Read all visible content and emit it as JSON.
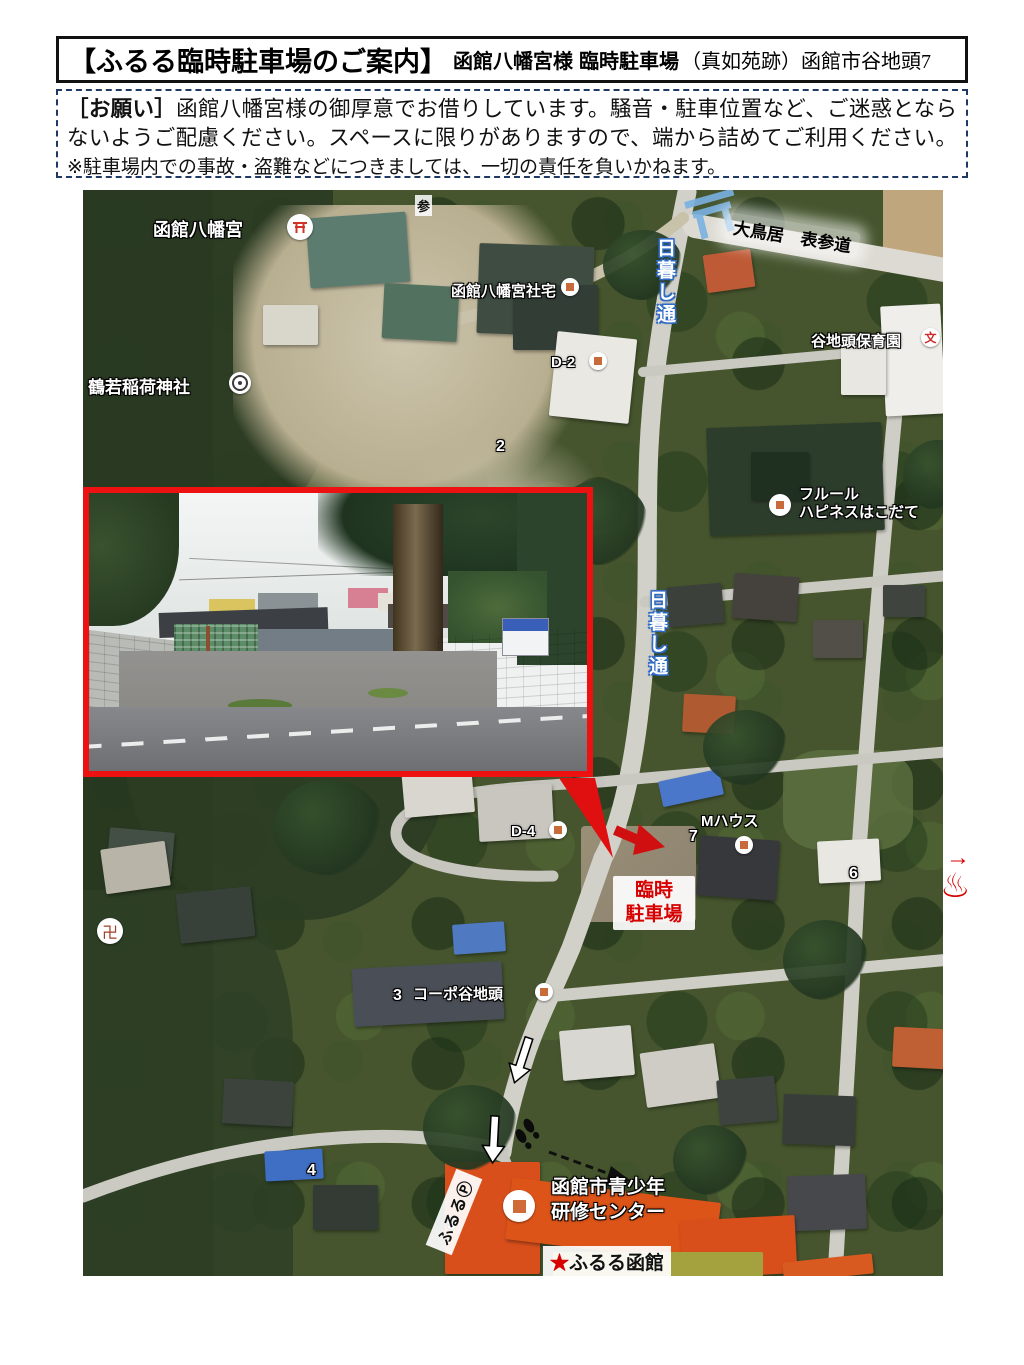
{
  "header": {
    "title_bracket": "【ふるる臨時駐車場のご案内】",
    "shrine_bold": "函館八幡宮様",
    "parking_bold": "臨時駐車場",
    "address_rest": "（真如苑跡）函館市谷地頭7"
  },
  "notice": {
    "label": "［お願い］",
    "body": "函館八幡宮様の御厚意でお借りしています。騒音・駐車位置など、ご迷惑とならないようご配慮ください。スペースに限りがありますので、端から詰めてご利用ください。",
    "disclaimer": "※駐車場内での事故・盗難などにつきましては、一切の責任を負いかねます。"
  },
  "map": {
    "labels": {
      "hachimangu": "函館八幡宮",
      "sando": "参",
      "shataku": "函館八幡宮社宅",
      "otorii_omotesando": "大鳥居　表参道",
      "road_name": "日暮し通",
      "hoikuen": "谷地頭保育園",
      "school_mark": "文",
      "inari": "鶴若稲荷神社",
      "d2": "D-2",
      "num2": "2",
      "fleur1": "フルール",
      "fleur2": "ハピネスはこだて",
      "d4": "D-4",
      "mhouse": "Mハウス",
      "num7": "7",
      "rinji1": "臨時",
      "rinji2": "駐車場",
      "manji": "卍",
      "num3": "3",
      "corpo": "コーポ谷地頭",
      "num6": "6",
      "num4": "4",
      "num5": "5",
      "fururu_p": "ふるるⓅ",
      "kenshu1": "函館市青少年",
      "kenshu2": "研修センター",
      "star": "★",
      "fururu_hakodate": "ふるる函館",
      "tani": "谷"
    },
    "margin_icons": {
      "arrow": "→",
      "onsen": "♨"
    }
  },
  "colors": {
    "accent_red": "#dd0000",
    "border_navy": "#1f3864",
    "road_blue": "#2f6bc4"
  }
}
